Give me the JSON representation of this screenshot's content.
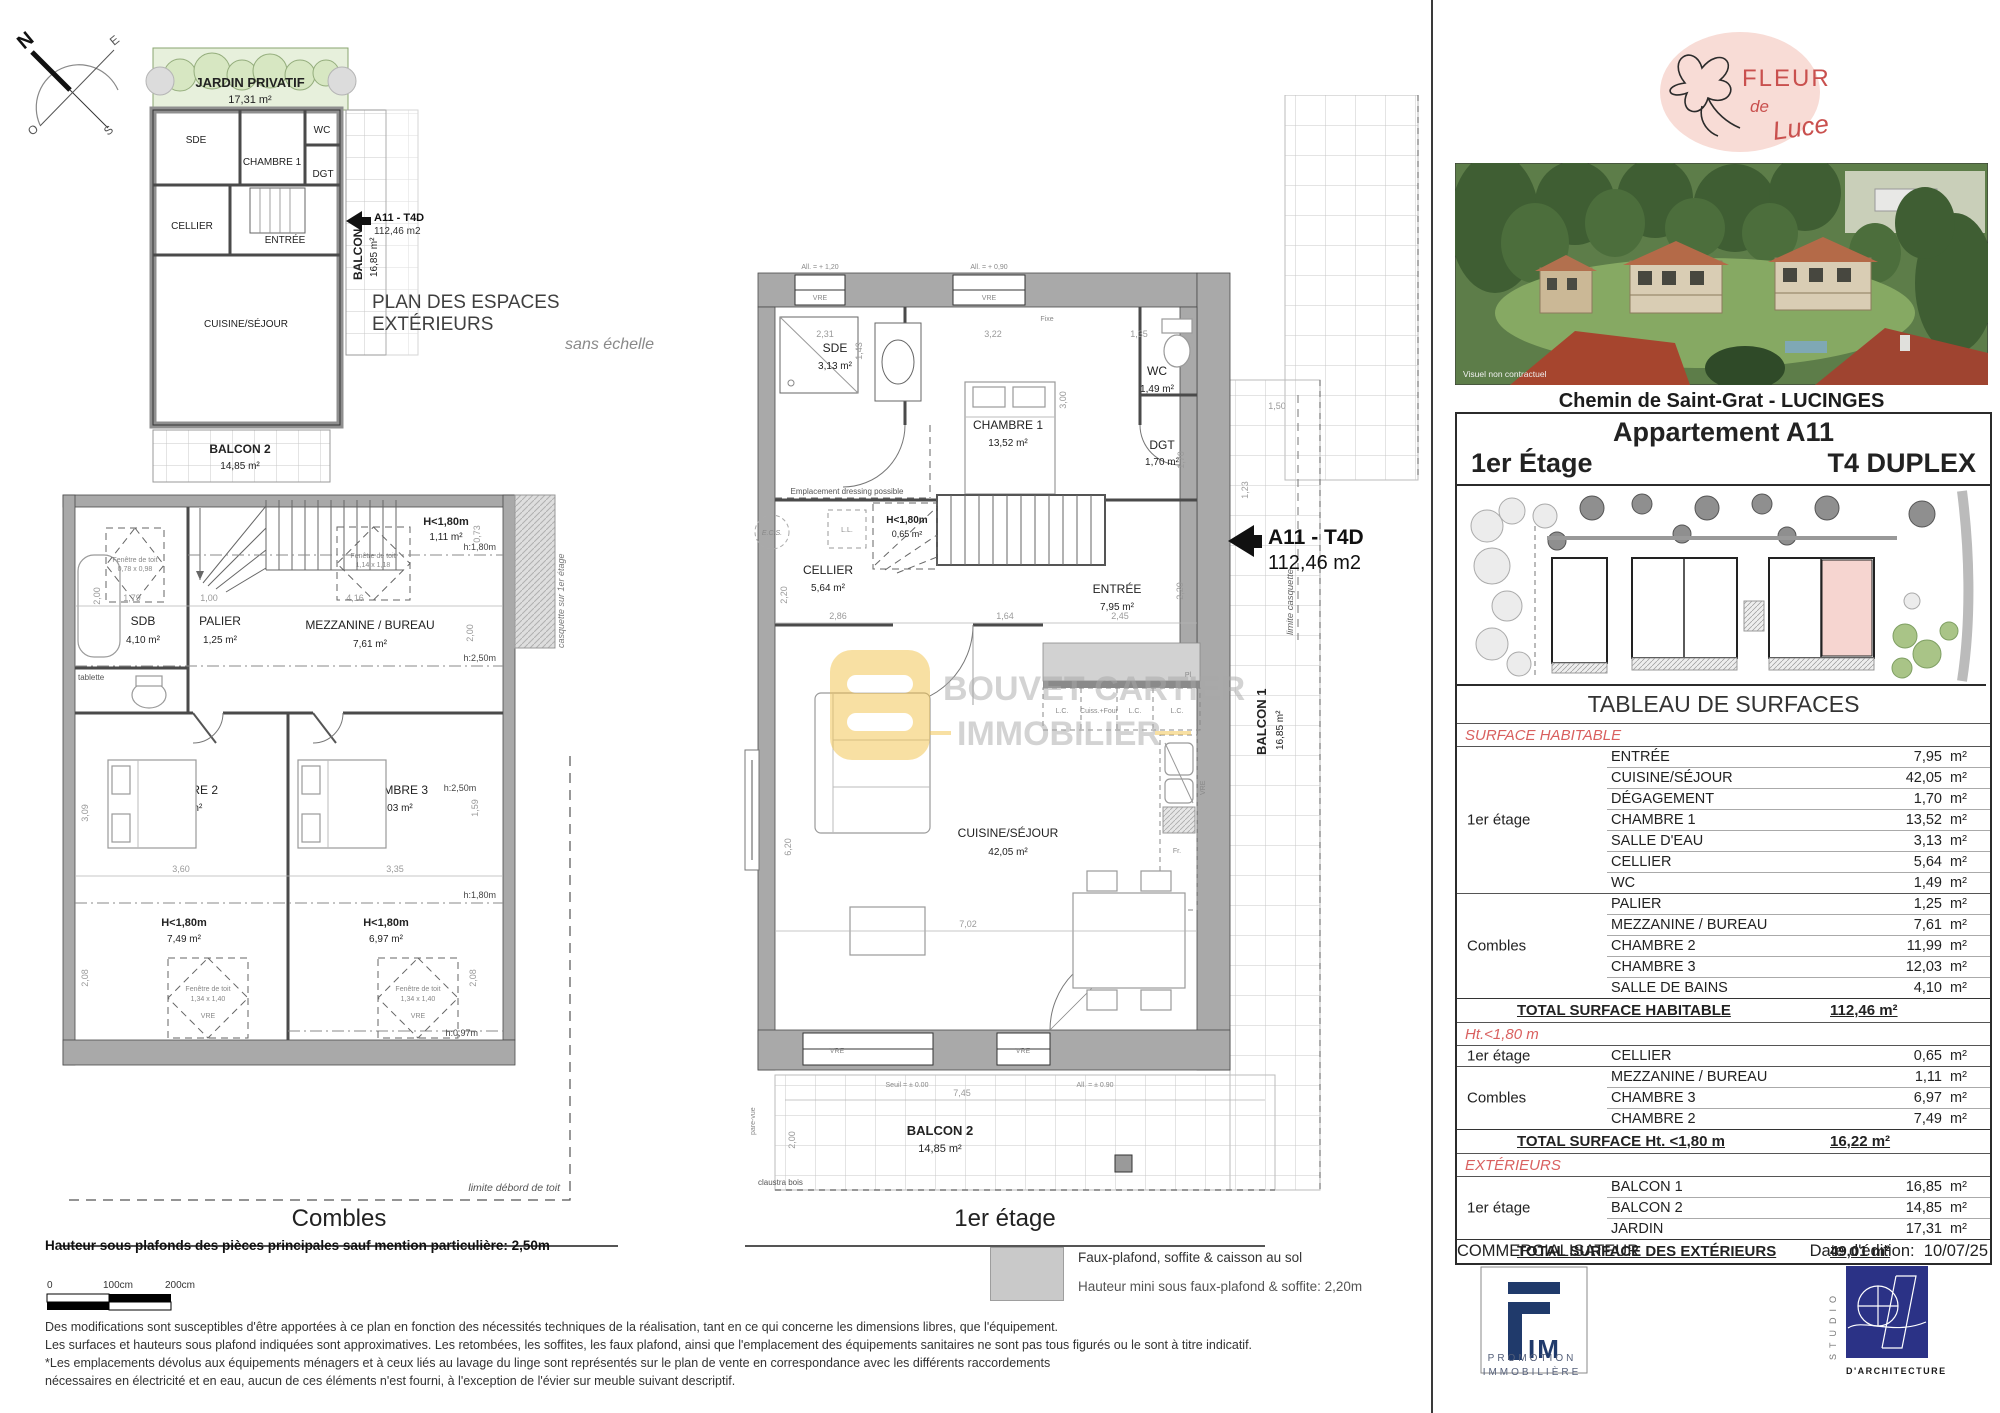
{
  "compass": {
    "n": "N",
    "e": "E",
    "s": "S",
    "o": "O"
  },
  "mini": {
    "title": "PLAN DES ESPACES EXTÉRIEURS",
    "subtitle": "sans échelle",
    "jardin": "JARDIN PRIVATIF",
    "jardin_a": "17,31 m²",
    "sde": "SDE",
    "chambre1": "CHAMBRE 1",
    "wc": "WC",
    "dgt": "DGT",
    "cellier": "CELLIER",
    "entree": "ENTRÉE",
    "cuisine": "CUISINE/SÉJOUR",
    "balcon1": "BALCON 1",
    "balcon1_a": "16,85 m²",
    "balcon2": "BALCON 2",
    "balcon2_a": "14,85 m²",
    "marker": "A11 - T4D",
    "marker_a": "112,46 m2"
  },
  "combles": {
    "title": "Combles",
    "sdb": "SDB",
    "sdb_a": "4,10 m²",
    "palier": "PALIER",
    "palier_a": "1,25 m²",
    "mezz": "MEZZANINE / BUREAU",
    "mezz_a": "7,61 m²",
    "ch2": "CHAMBRE 2",
    "ch2_a": "11,99 m²",
    "ch3": "CHAMBRE 3",
    "ch3_a": "12,03 m²",
    "h180": "H<1,80m",
    "h180_top_a": "1,11 m²",
    "h180_ch2_a": "7,49 m²",
    "h180_ch3_a": "6,97 m²",
    "h_180": "h:1,80m",
    "h_250": "h:2,50m",
    "h_097": "h:0,97m",
    "tablette": "tablette",
    "fen": "Fenêtre de toit",
    "fen_s1": "0,78 x 0,98",
    "fen_s2": "1,14 x 1,18",
    "fen_s3": "1,34 x 1,40",
    "vre": "VRE",
    "casquette": "casquette sur 1er étage",
    "limite": "limite débord de toit",
    "dims": [
      "2,00",
      "1,79",
      "1,00",
      "4,16",
      "0,73",
      "2,00",
      "3,09",
      "3,60",
      "3,35",
      "1,59",
      "2,08",
      "2,08"
    ]
  },
  "etage": {
    "title": "1er étage",
    "sde": "SDE",
    "sde_a": "3,13 m²",
    "ch1": "CHAMBRE 1",
    "ch1_a": "13,52 m²",
    "wc": "WC",
    "wc_a": "1,49 m²",
    "dgt": "DGT",
    "dgt_a": "1,70 m²",
    "cellier": "CELLIER",
    "cellier_a": "5,64 m²",
    "entree": "ENTRÉE",
    "entree_a": "7,95 m²",
    "cuisine": "CUISINE/SÉJOUR",
    "cuisine_a": "42,05 m²",
    "h180": "H<1,80m",
    "h180_a": "0,65 m²",
    "balcon1": "BALCON 1",
    "balcon1_a": "16,85 m²",
    "balcon2": "BALCON 2",
    "balcon2_a": "14,85 m²",
    "ecs": "E.C.S.",
    "ll": "L.L.",
    "dressing": "Emplacement dressing possible",
    "lc": "L.C.",
    "cuiss": "Cuiss.+Four",
    "pl": "Pl",
    "fr": "Fr.",
    "vre": "VRE",
    "fixe": "Fixe",
    "seuil": "Seuil = ± 0.00",
    "all090b": "All. = ± 0.90",
    "all120": "All. = + 1,20",
    "all090": "All. = + 0,90",
    "claustra": "claustra bois",
    "parevue": "pare-vue",
    "limite": "limite casquette",
    "marker": "A11 - T4D",
    "marker_a": "112,46 m2",
    "wm1": "BOUVET CARTIER",
    "wm2": "IMMOBILIER",
    "dims": [
      "2,31",
      "3,22",
      "1,35",
      "3,00",
      "1,43",
      "1,70",
      "2,20",
      "2,86",
      "1,64",
      "2,45",
      "2,20",
      "6,20",
      "7,02",
      "7,45",
      "2,00",
      "1,50",
      "1,23"
    ]
  },
  "legend": {
    "line1": "Faux-plafond, soffite & caisson au sol",
    "line2": "Hauteur mini sous faux-plafond & soffite: 2,20m"
  },
  "footnote": {
    "heights": "Hauteur sous plafonds des pièces principales sauf mention particulière: 2,50m",
    "scale": [
      "0",
      "100cm",
      "200cm"
    ],
    "lines": [
      "Des modifications sont susceptibles d'être apportées à ce plan en fonction des nécessités techniques de la réalisation, tant en ce qui concerne les dimensions libres, que l'équipement.",
      "Les surfaces et hauteurs sous plafond indiquées sont approximatives. Les retombées, les soffites, les faux plafond, ainsi que l'emplacement des équipements sanitaires ne sont pas tous figurés ou le sont à titre indicatif.",
      "*Les emplacements dévolus aux équipements ménagers et à ceux liés au lavage du linge sont représentés sur le plan de vente en correspondance avec les différents raccordements",
      "nécessaires en électricité et en eau, aucun de ces éléments n'est fourni, à l'exception de l'évier sur meuble suivant descriptif."
    ]
  },
  "panel": {
    "brand": {
      "fleur": "FLEUR",
      "de": "de",
      "luce": "Luce"
    },
    "photo_caption": "Visuel non contractuel",
    "address": "Chemin de Saint-Grat - LUCINGES",
    "apt_title": "Appartement A11",
    "apt_floor": "1er Étage",
    "apt_type": "T4 DUPLEX",
    "commercial": "COMMERCIALISATEUR",
    "date_label": "Date d'édition:",
    "date": "10/07/25",
    "fim_im": "IM",
    "fim_line1": "PROMOTION",
    "fim_line2": "IMMOBILIÈRE",
    "studio_vertical": "STUDIO",
    "studio_label": "D'ARCHITECTURE"
  },
  "surfaces": {
    "title": "TABLEAU DE SURFACES",
    "unit": "m²",
    "floor_1er": "1er étage",
    "floor_combles": "Combles",
    "hab_header": "SURFACE HABITABLE",
    "hab_1er": [
      {
        "room": "ENTRÉE",
        "value": "7,95"
      },
      {
        "room": "CUISINE/SÉJOUR",
        "value": "42,05"
      },
      {
        "room": "DÉGAGEMENT",
        "value": "1,70"
      },
      {
        "room": "CHAMBRE 1",
        "value": "13,52"
      },
      {
        "room": "SALLE D'EAU",
        "value": "3,13"
      },
      {
        "room": "CELLIER",
        "value": "5,64"
      },
      {
        "room": "WC",
        "value": "1,49"
      }
    ],
    "hab_combles": [
      {
        "room": "PALIER",
        "value": "1,25"
      },
      {
        "room": "MEZZANINE / BUREAU",
        "value": "7,61"
      },
      {
        "room": "CHAMBRE 2",
        "value": "11,99"
      },
      {
        "room": "CHAMBRE 3",
        "value": "12,03"
      },
      {
        "room": "SALLE DE BAINS",
        "value": "4,10"
      }
    ],
    "hab_total_label": "TOTAL SURFACE HABITABLE",
    "hab_total": "112,46 m²",
    "ht_header": "Ht.<1,80 m",
    "ht_1er": [
      {
        "room": "CELLIER",
        "value": "0,65"
      }
    ],
    "ht_combles": [
      {
        "room": "MEZZANINE / BUREAU",
        "value": "1,11"
      },
      {
        "room": "CHAMBRE 3",
        "value": "6,97"
      },
      {
        "room": "CHAMBRE 2",
        "value": "7,49"
      }
    ],
    "ht_total_label": "TOTAL SURFACE Ht. <1,80 m",
    "ht_total": "16,22 m²",
    "ext_header": "EXTÉRIEURS",
    "ext_1er": [
      {
        "room": "BALCON 1",
        "value": "16,85"
      },
      {
        "room": "BALCON 2",
        "value": "14,85"
      },
      {
        "room": "JARDIN",
        "value": "17,31"
      }
    ],
    "ext_total_label": "TOTAL SURFACE  DES EXTÉRIEURS",
    "ext_total": "49,01 m²"
  }
}
